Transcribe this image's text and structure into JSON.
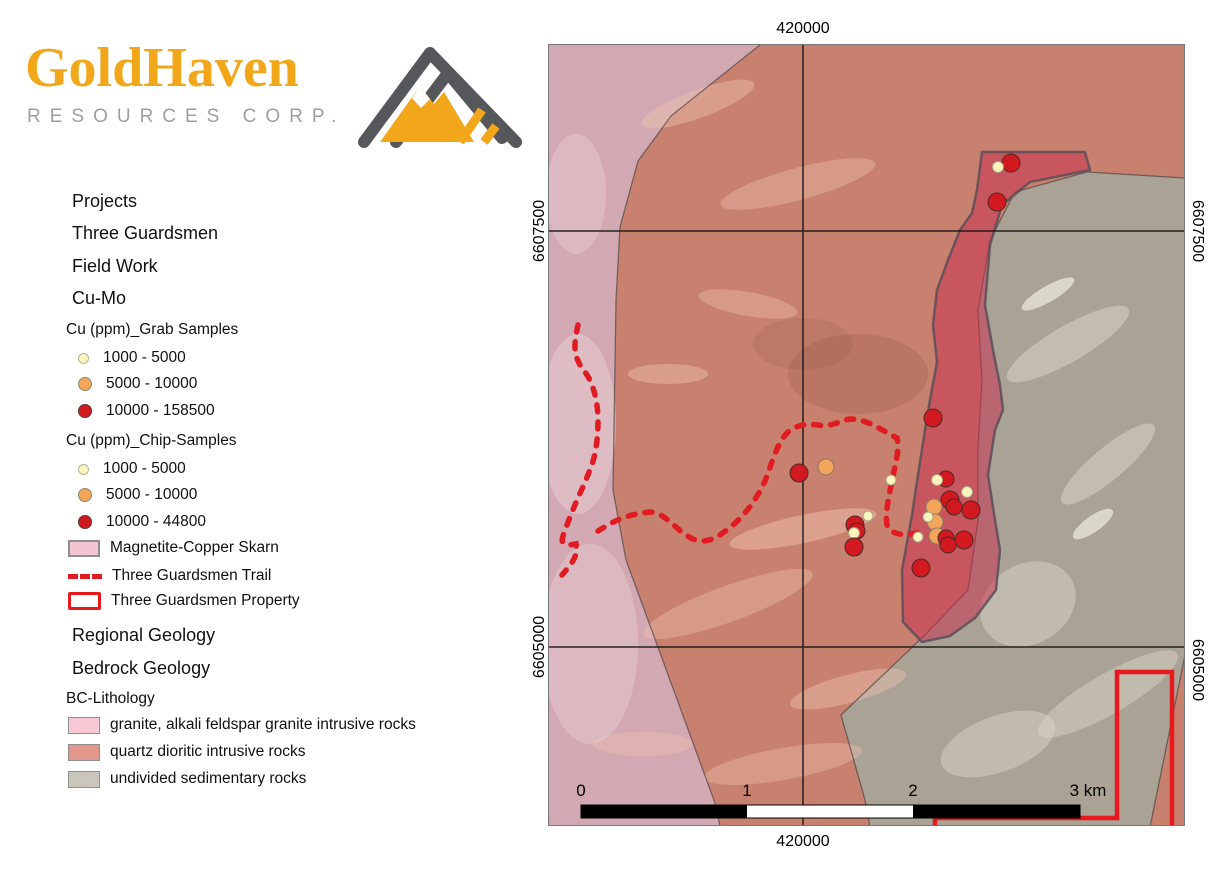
{
  "brand": {
    "word1": "Gold",
    "word2": "Haven",
    "subtitle": "RESOURCES CORP.",
    "gold": "#F2A71B",
    "gray": "#9B9EA3"
  },
  "legend": {
    "projects_label": "Projects",
    "three_guardsmen_label": "Three Guardsmen",
    "field_work_label": "Field Work",
    "cu_mo_label": "Cu-Mo",
    "grab": {
      "title": "Cu (ppm)_Grab Samples",
      "classes": [
        {
          "label": "1000 - 5000",
          "color": "#FBF3BC"
        },
        {
          "label": "5000 - 10000",
          "color": "#F4A55C"
        },
        {
          "label": "10000 - 158500",
          "color": "#D2191F"
        }
      ]
    },
    "chip": {
      "title": "Cu (ppm)_Chip-Samples",
      "classes": [
        {
          "label": "1000 - 5000",
          "color": "#FBF3BC"
        },
        {
          "label": "5000 - 10000",
          "color": "#F4A55C"
        },
        {
          "label": "10000 - 44800",
          "color": "#D2191F"
        }
      ]
    },
    "skarn": {
      "label": "Magnetite-Copper Skarn",
      "fill": "#F2C5D1"
    },
    "trail": {
      "label": "Three Guardsmen Trail",
      "color": "#E01B22"
    },
    "property": {
      "label": "Three Guardsmen Property",
      "color": "#E8191C"
    },
    "regional_label": "Regional Geology",
    "bedrock_label": "Bedrock Geology",
    "lithology": {
      "title": "BC-Lithology",
      "classes": [
        {
          "label": "granite, alkali feldspar granite intrusive rocks",
          "color": "#F6C9D5"
        },
        {
          "label": "quartz dioritic intrusive rocks",
          "color": "#E2988C"
        },
        {
          "label": "undivided sedimentary rocks",
          "color": "#CBC6BB"
        }
      ]
    }
  },
  "map": {
    "labels": {
      "top": "420000",
      "bottom": "420000",
      "left_top": "6607500",
      "left_bottom": "6605000",
      "right_top": "6607500",
      "right_bottom": "6605000"
    },
    "scalebar": {
      "t0": "0",
      "t1": "1",
      "t2": "2",
      "t3": "3 km"
    },
    "colors": {
      "granite": "#d2a9b3",
      "quartz_diorite": "#c8806f",
      "sedimentary": "#a9a295",
      "skarn_fill": "rgba(199,48,80,0.52)",
      "skarn_stroke": "rgba(92,78,88,0.85)",
      "trail": "#E01B22",
      "property": "#E8191C",
      "grid": "#141414"
    },
    "sample_colors": {
      "l": {
        "fill": "#FBF3BC",
        "stroke": "#a9a486"
      },
      "m": {
        "fill": "#F4A55C",
        "stroke": "#8c7a5e"
      },
      "h": {
        "fill": "#D2191F",
        "stroke": "#4d2a28"
      }
    },
    "samples": [
      {
        "x": 463,
        "y": 119,
        "r": 9,
        "k": "h"
      },
      {
        "x": 450,
        "y": 123,
        "r": 5.5,
        "k": "l"
      },
      {
        "x": 449,
        "y": 158,
        "r": 9,
        "k": "h"
      },
      {
        "x": 385,
        "y": 374,
        "r": 9,
        "k": "h"
      },
      {
        "x": 251,
        "y": 429,
        "r": 9,
        "k": "h"
      },
      {
        "x": 278,
        "y": 423,
        "r": 8,
        "k": "m"
      },
      {
        "x": 398,
        "y": 435,
        "r": 8,
        "k": "h"
      },
      {
        "x": 389,
        "y": 436,
        "r": 5.5,
        "k": "l"
      },
      {
        "x": 343,
        "y": 436,
        "r": 5,
        "k": "l"
      },
      {
        "x": 402,
        "y": 456,
        "r": 9,
        "k": "h"
      },
      {
        "x": 406,
        "y": 463,
        "r": 8,
        "k": "h"
      },
      {
        "x": 423,
        "y": 466,
        "r": 9,
        "k": "h"
      },
      {
        "x": 419,
        "y": 448,
        "r": 5.5,
        "k": "l"
      },
      {
        "x": 386,
        "y": 463,
        "r": 8,
        "k": "m"
      },
      {
        "x": 387,
        "y": 478,
        "r": 8,
        "k": "m"
      },
      {
        "x": 380,
        "y": 473,
        "r": 5,
        "k": "l"
      },
      {
        "x": 307,
        "y": 481,
        "r": 9,
        "k": "h"
      },
      {
        "x": 309,
        "y": 487,
        "r": 8,
        "k": "h"
      },
      {
        "x": 306,
        "y": 489,
        "r": 5.5,
        "k": "l"
      },
      {
        "x": 320,
        "y": 472,
        "r": 5,
        "k": "l"
      },
      {
        "x": 389,
        "y": 492,
        "r": 8,
        "k": "m"
      },
      {
        "x": 398,
        "y": 494,
        "r": 8,
        "k": "h"
      },
      {
        "x": 400,
        "y": 501,
        "r": 8,
        "k": "h"
      },
      {
        "x": 416,
        "y": 496,
        "r": 9,
        "k": "h"
      },
      {
        "x": 370,
        "y": 493,
        "r": 5,
        "k": "l"
      },
      {
        "x": 306,
        "y": 503,
        "r": 9,
        "k": "h"
      },
      {
        "x": 373,
        "y": 524,
        "r": 9,
        "k": "h"
      }
    ]
  }
}
